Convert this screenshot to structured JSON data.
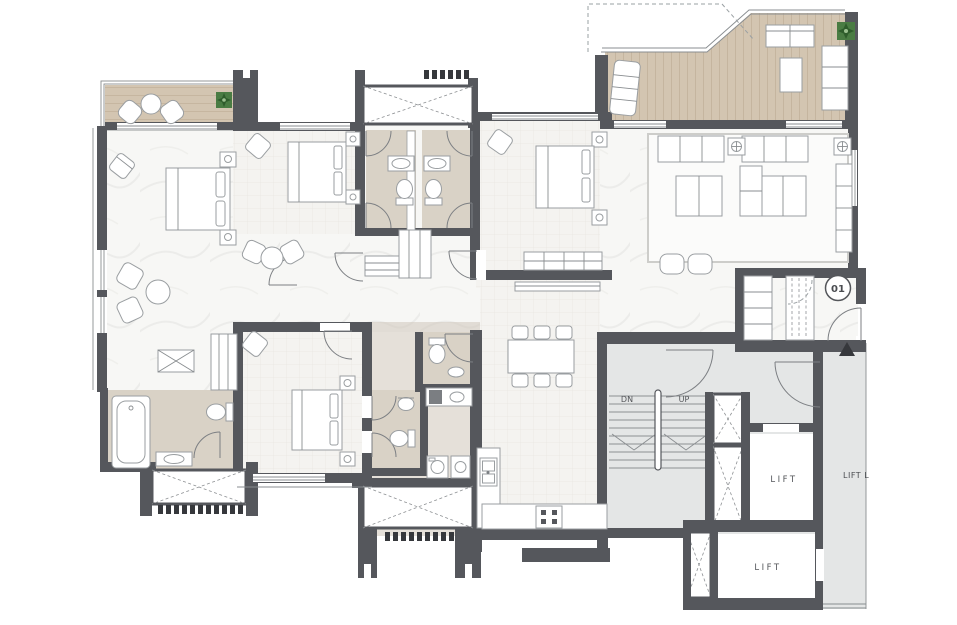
{
  "plan": {
    "unit_number": "01",
    "labels": {
      "stairs_down": "DN",
      "stairs_up": "UP",
      "lift_upper": "LIFT",
      "lift_lower": "LIFT",
      "lift_lobby": "LIFT L"
    }
  },
  "colors": {
    "wall": "#55575c",
    "wall_dark": "#36383c",
    "floor": "#f7f7f5",
    "tile": "#f4f3f0",
    "tile_line": "#e8e6e1",
    "bath": "#d9d2c6",
    "bath_dark": "#cfc7b9",
    "wood": "#d3c5b1",
    "wood_line": "#c2b19b",
    "common": "#e4e6e6",
    "line": "#898d90",
    "furniture": "#ffffff",
    "furniture_stroke": "#9a9ea1",
    "plant": "#4a7c43",
    "plant_dark": "#2e5c2b",
    "text": "#4a4c50"
  }
}
